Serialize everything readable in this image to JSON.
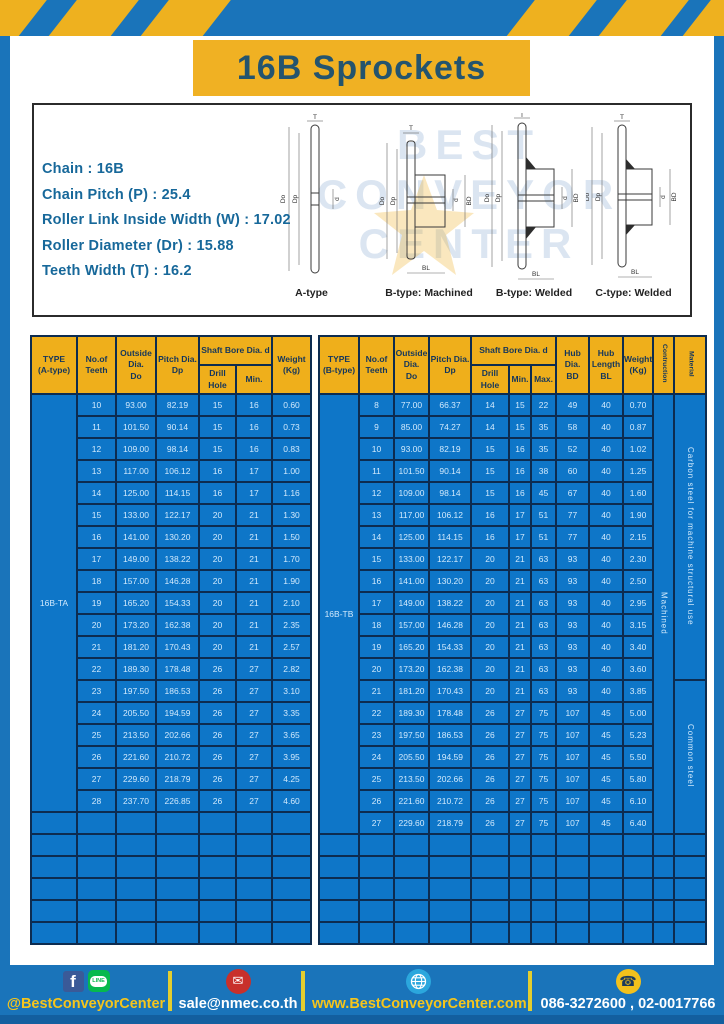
{
  "header": {
    "title": "16B Sprockets"
  },
  "specs": {
    "lines": [
      "Chain : 16B",
      "Chain Pitch (P) : 25.4",
      "Roller Link Inside Width (W) : 17.02",
      "Roller Diameter (Dr) : 15.88",
      "Teeth Width (T) : 16.2"
    ]
  },
  "watermark": {
    "lines": [
      "BEST",
      "CONVEYOR",
      "CENTER"
    ]
  },
  "drawings": {
    "dims": {
      "t": "T",
      "do": "Do",
      "dp": "Dp",
      "d": "d",
      "bd": "BD",
      "bl": "BL"
    },
    "items": [
      {
        "label": "A-type"
      },
      {
        "label": "B-type: Machined"
      },
      {
        "label": "B-type: Welded"
      },
      {
        "label": "C-type: Welded"
      }
    ]
  },
  "table_a": {
    "headers": {
      "type": "TYPE\n(A-type)",
      "teeth": "No.of\nTeeth",
      "outside": "Outside\nDia.\nDo",
      "pitch": "Pitch Dia.\nDp",
      "shaft_bore": "Shaft Bore Dia. d",
      "drill": "Drill Hole",
      "min": "Min.",
      "weight": "Weight\n(Kg)"
    },
    "type_label": "16B-TA",
    "rows": [
      [
        "10",
        "93.00",
        "82.19",
        "15",
        "16",
        "0.60"
      ],
      [
        "11",
        "101.50",
        "90.14",
        "15",
        "16",
        "0.73"
      ],
      [
        "12",
        "109.00",
        "98.14",
        "15",
        "16",
        "0.83"
      ],
      [
        "13",
        "117.00",
        "106.12",
        "16",
        "17",
        "1.00"
      ],
      [
        "14",
        "125.00",
        "114.15",
        "16",
        "17",
        "1.16"
      ],
      [
        "15",
        "133.00",
        "122.17",
        "20",
        "21",
        "1.30"
      ],
      [
        "16",
        "141.00",
        "130.20",
        "20",
        "21",
        "1.50"
      ],
      [
        "17",
        "149.00",
        "138.22",
        "20",
        "21",
        "1.70"
      ],
      [
        "18",
        "157.00",
        "146.28",
        "20",
        "21",
        "1.90"
      ],
      [
        "19",
        "165.20",
        "154.33",
        "20",
        "21",
        "2.10"
      ],
      [
        "20",
        "173.20",
        "162.38",
        "20",
        "21",
        "2.35"
      ],
      [
        "21",
        "181.20",
        "170.43",
        "20",
        "21",
        "2.57"
      ],
      [
        "22",
        "189.30",
        "178.48",
        "26",
        "27",
        "2.82"
      ],
      [
        "23",
        "197.50",
        "186.53",
        "26",
        "27",
        "3.10"
      ],
      [
        "24",
        "205.50",
        "194.59",
        "26",
        "27",
        "3.35"
      ],
      [
        "25",
        "213.50",
        "202.66",
        "26",
        "27",
        "3.65"
      ],
      [
        "26",
        "221.60",
        "210.72",
        "26",
        "27",
        "3.95"
      ],
      [
        "27",
        "229.60",
        "218.79",
        "26",
        "27",
        "4.25"
      ],
      [
        "28",
        "237.70",
        "226.85",
        "26",
        "27",
        "4.60"
      ]
    ],
    "empty_rows": 6,
    "empty_cols": 7
  },
  "table_b": {
    "headers": {
      "type": "TYPE\n(B-type)",
      "teeth": "No.of\nTeeth",
      "outside": "Outside\nDia.\nDo",
      "pitch": "Pitch Dia.\nDp",
      "shaft_bore": "Shaft Bore Dia. d",
      "drill": "Drill Hole",
      "min": "Min.",
      "max": "Max.",
      "hub_dia": "Hub Dia.\nBD",
      "hub_len": "Hub\nLength\nBL",
      "weight": "Weight\n(Kg)",
      "construction": "Contruction",
      "material": "Material"
    },
    "type_label": "16B-TB",
    "construction": "Machined",
    "materials": [
      {
        "text": "Carbon steel for machine structural use",
        "rows": 13
      },
      {
        "text": "Common steel",
        "rows": 7
      }
    ],
    "rows": [
      [
        "8",
        "77.00",
        "66.37",
        "14",
        "15",
        "22",
        "49",
        "40",
        "0.70"
      ],
      [
        "9",
        "85.00",
        "74.27",
        "14",
        "15",
        "35",
        "58",
        "40",
        "0.87"
      ],
      [
        "10",
        "93.00",
        "82.19",
        "15",
        "16",
        "35",
        "52",
        "40",
        "1.02"
      ],
      [
        "11",
        "101.50",
        "90.14",
        "15",
        "16",
        "38",
        "60",
        "40",
        "1.25"
      ],
      [
        "12",
        "109.00",
        "98.14",
        "15",
        "16",
        "45",
        "67",
        "40",
        "1.60"
      ],
      [
        "13",
        "117.00",
        "106.12",
        "16",
        "17",
        "51",
        "77",
        "40",
        "1.90"
      ],
      [
        "14",
        "125.00",
        "114.15",
        "16",
        "17",
        "51",
        "77",
        "40",
        "2.15"
      ],
      [
        "15",
        "133.00",
        "122.17",
        "20",
        "21",
        "63",
        "93",
        "40",
        "2.30"
      ],
      [
        "16",
        "141.00",
        "130.20",
        "20",
        "21",
        "63",
        "93",
        "40",
        "2.50"
      ],
      [
        "17",
        "149.00",
        "138.22",
        "20",
        "21",
        "63",
        "93",
        "40",
        "2.95"
      ],
      [
        "18",
        "157.00",
        "146.28",
        "20",
        "21",
        "63",
        "93",
        "40",
        "3.15"
      ],
      [
        "19",
        "165.20",
        "154.33",
        "20",
        "21",
        "63",
        "93",
        "40",
        "3.40"
      ],
      [
        "20",
        "173.20",
        "162.38",
        "20",
        "21",
        "63",
        "93",
        "40",
        "3.60"
      ],
      [
        "21",
        "181.20",
        "170.43",
        "20",
        "21",
        "63",
        "93",
        "40",
        "3.85"
      ],
      [
        "22",
        "189.30",
        "178.48",
        "26",
        "27",
        "75",
        "107",
        "45",
        "5.00"
      ],
      [
        "23",
        "197.50",
        "186.53",
        "26",
        "27",
        "75",
        "107",
        "45",
        "5.23"
      ],
      [
        "24",
        "205.50",
        "194.59",
        "26",
        "27",
        "75",
        "107",
        "45",
        "5.50"
      ],
      [
        "25",
        "213.50",
        "202.66",
        "26",
        "27",
        "75",
        "107",
        "45",
        "5.80"
      ],
      [
        "26",
        "221.60",
        "210.72",
        "26",
        "27",
        "75",
        "107",
        "45",
        "6.10"
      ],
      [
        "27",
        "229.60",
        "218.79",
        "26",
        "27",
        "75",
        "107",
        "45",
        "6.40"
      ]
    ],
    "empty_rows": 5,
    "empty_cols": 12
  },
  "footer": {
    "facebook_label": "f",
    "line_label": "LINE",
    "social": "@BestConveyorCenter",
    "mail_glyph": "✉",
    "email": "sale@nmec.co.th",
    "website": "www.BestConveyorCenter.com",
    "phone_glyph": "☎",
    "phones": "086-3272600 , 02-0017766"
  },
  "colors": {
    "frame_blue": "#1a74ba",
    "band_yellow": "#eeb11f",
    "table_blue": "#0e76c8",
    "header_yellow": "#efaf1b",
    "border_navy": "#0d2c50",
    "title_text": "#24546e",
    "spec_text": "#17689a",
    "cell_text": "#d2eafd"
  }
}
